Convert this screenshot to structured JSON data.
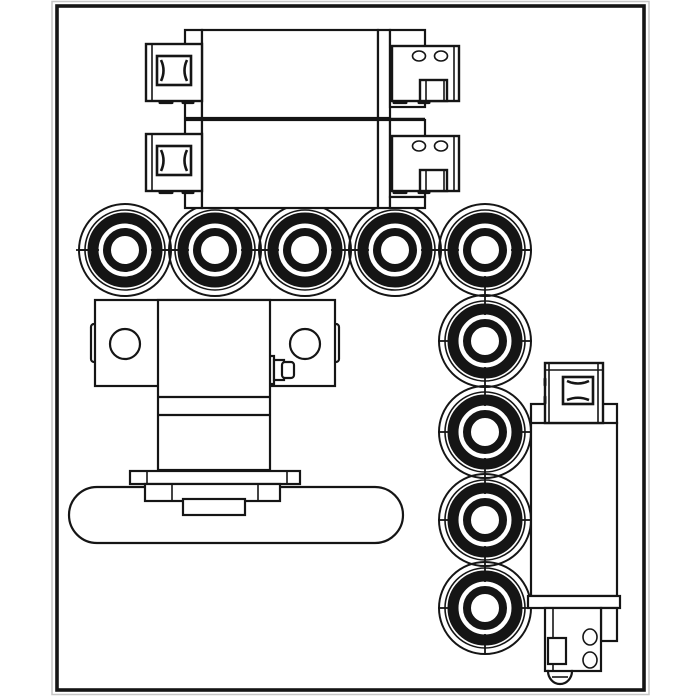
{
  "canvas": {
    "width": 700,
    "height": 700
  },
  "colors": {
    "ink": "#151515",
    "paper": "#ffffff",
    "frame_shadow": "#c6c6c6"
  },
  "frame": {
    "x": 57,
    "y": 6,
    "width": 587,
    "height": 684
  },
  "bearings": {
    "count": 9,
    "outer_radius": 46,
    "ring_radii": {
      "outer_thin": 46,
      "outer_thin2": 40,
      "band_outer": 37.5,
      "band_inner": 26.5,
      "inner_ring_outer": 22,
      "inner_ring_inner": 14
    },
    "row_axis_y": 250,
    "column_axis_x": 485,
    "centers": [
      [
        125,
        250
      ],
      [
        215,
        250
      ],
      [
        305,
        250
      ],
      [
        395,
        250
      ],
      [
        485,
        250
      ],
      [
        485,
        341
      ],
      [
        485,
        432
      ],
      [
        485,
        520
      ],
      [
        485,
        608
      ]
    ],
    "row_line": {
      "x1": 76,
      "y1": 250,
      "x2": 531,
      "y2": 250
    },
    "column_line": {
      "x1": 485,
      "y1": 250,
      "x2": 485,
      "y2": 653
    }
  },
  "valve_units": {
    "count": 2,
    "offsets_y": [
      30,
      120
    ],
    "separator_line": {
      "x1": 185,
      "y1": 119,
      "x2": 425,
      "y2": 119
    },
    "features_per_unit": {
      "din_connector_square": 1,
      "end_cap_port_holes": 2,
      "end_cap_tab": 1
    }
  },
  "mounting_block": {
    "holes": [
      [
        125,
        344
      ],
      [
        305,
        344
      ]
    ],
    "hole_radius": 15
  },
  "base_plate": {
    "stadium": {
      "x": 69,
      "y": 487,
      "width": 334,
      "height": 56,
      "corner_radius": 28
    }
  },
  "solenoid": {
    "port_holes": [
      [
        590,
        637
      ],
      [
        590,
        660
      ]
    ],
    "port_hole_rx": 7,
    "port_hole_ry": 8
  },
  "components": [
    {
      "name": "valve-unit-1",
      "kind": "stacked rectangular valve body, top"
    },
    {
      "name": "valve-unit-2",
      "kind": "stacked rectangular valve body, bottom"
    },
    {
      "name": "din-connector",
      "count": 3,
      "kind": "square plug connector"
    },
    {
      "name": "end-cap",
      "count": 2,
      "kind": "right-hand cap with two round ports and square tab"
    },
    {
      "name": "roller-bearing",
      "count": 9,
      "kind": "concentric-ring roller, 5 across and 4 down"
    },
    {
      "name": "mounting-block",
      "kind": "T-shaped block with two bolt holes and side plug"
    },
    {
      "name": "base-plate",
      "kind": "rounded-end (stadium) base bar with flange stack"
    },
    {
      "name": "solenoid-cartridge",
      "kind": "tall right-hand body with top connector and bottom ports"
    }
  ]
}
